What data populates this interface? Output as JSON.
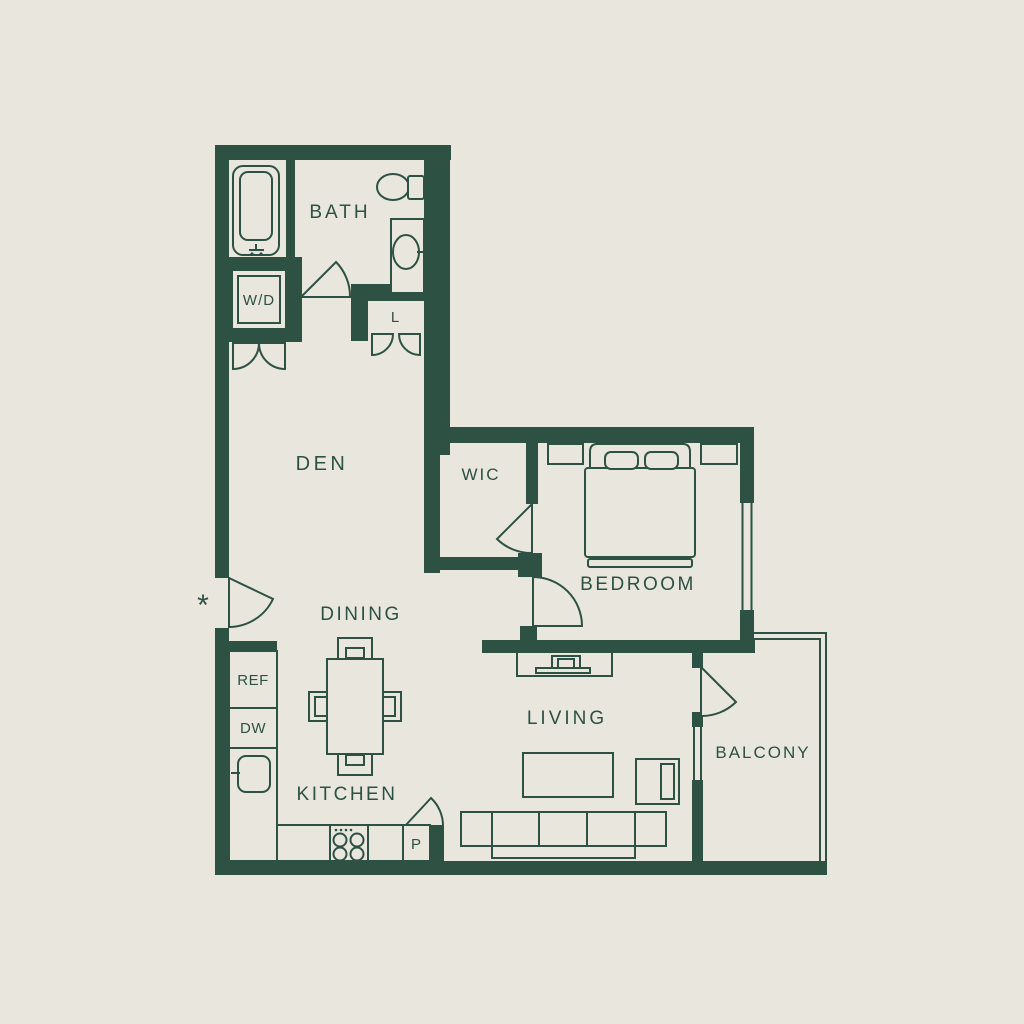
{
  "colors": {
    "background": "#e9e6de",
    "wall": "#2d5143",
    "text": "#2d5143"
  },
  "rooms": {
    "bath": "BATH",
    "den": "DEN",
    "wic": "WIC",
    "bedroom": "BEDROOM",
    "dining": "DINING",
    "living": "LIVING",
    "kitchen": "KITCHEN",
    "balcony": "BALCONY"
  },
  "labels": {
    "washer_dryer": "W/D",
    "linen_closet": "L",
    "refrigerator": "REF",
    "dishwasher": "DW",
    "pantry": "P",
    "entry_marker": "*"
  }
}
